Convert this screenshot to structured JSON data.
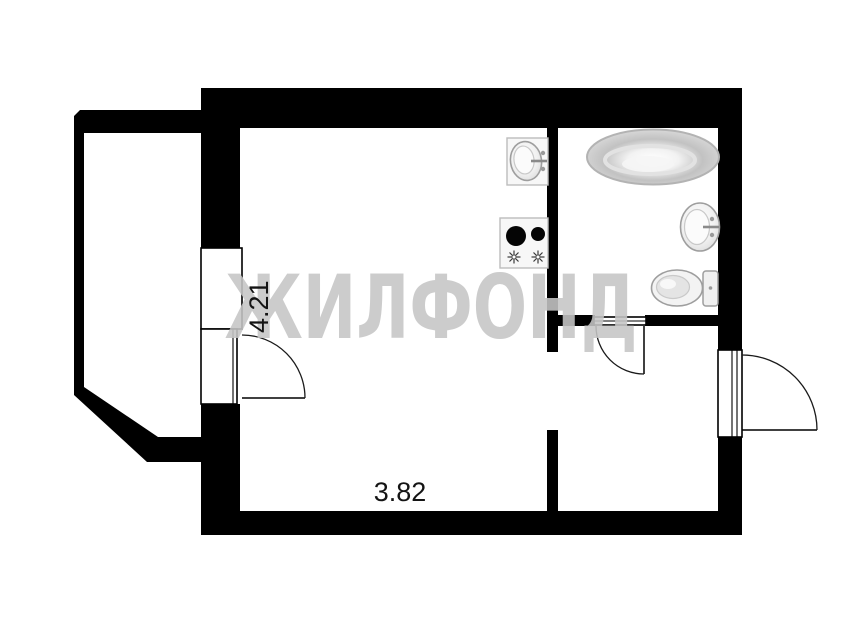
{
  "watermark": {
    "text": "ЖИЛФОНД",
    "color": "#c6c6c6"
  },
  "dimensions": {
    "vertical_label": "4.21",
    "horizontal_label": "3.82"
  },
  "plan": {
    "wall_color": "#000000",
    "background_color": "#ffffff",
    "fixture_outline_color": "#9e9e9e",
    "fixtures": [
      {
        "name": "bathtub-icon"
      },
      {
        "name": "wash-basin-icon"
      },
      {
        "name": "toilet-icon"
      },
      {
        "name": "kitchen-sink-icon"
      },
      {
        "name": "stove-icon"
      }
    ],
    "doors": [
      {
        "name": "balcony-door"
      },
      {
        "name": "bathroom-door"
      },
      {
        "name": "entry-door"
      }
    ],
    "rooms": [
      {
        "name": "balcony"
      },
      {
        "name": "main-room-kitchen"
      },
      {
        "name": "bathroom"
      },
      {
        "name": "hallway"
      }
    ]
  }
}
